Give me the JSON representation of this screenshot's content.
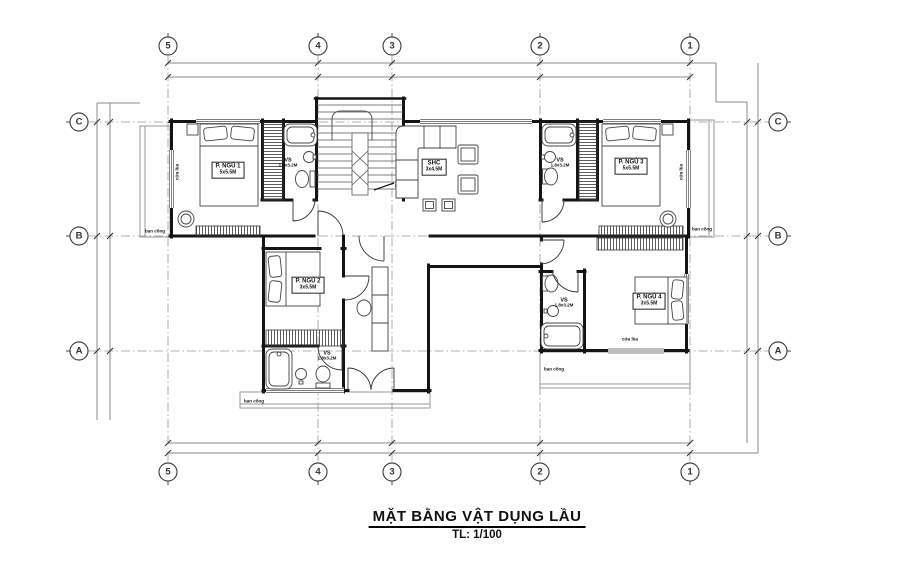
{
  "title": {
    "text": "MẶT BẰNG VẬT DỤNG LẦU",
    "scale": "TL: 1/100"
  },
  "grid": {
    "cols": [
      "5",
      "4",
      "3",
      "2",
      "1"
    ],
    "rows": [
      "C",
      "B",
      "A"
    ]
  },
  "rooms": {
    "bedroom1": {
      "name": "P. NGỦ 1",
      "dims": "5x5.5M"
    },
    "bedroom2": {
      "name": "P. NGỦ 2",
      "dims": "3x5.5M"
    },
    "bedroom3": {
      "name": "P. NGỦ 3",
      "dims": "5x5.5M"
    },
    "bedroom4": {
      "name": "P. NGỦ 4",
      "dims": "3x5.5M"
    },
    "living": {
      "name": "SHC",
      "dims": "3x4.5M"
    },
    "bath": {
      "name": "VS",
      "dims": "1.8x3.2M"
    }
  },
  "labels": {
    "balcony": "ban công",
    "sliding_door": "cửa lùa"
  },
  "colors": {
    "ink": "#141414",
    "grid_line": "#999999",
    "dim_line": "#8a8a8a"
  }
}
